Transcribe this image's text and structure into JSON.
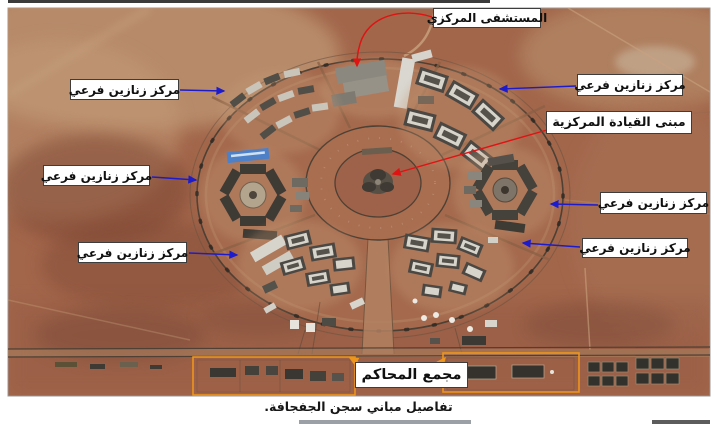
{
  "figure": {
    "caption": "تفاصيل مباني سجن الجفجافة."
  },
  "annotations": {
    "labels": [
      {
        "id": "central-hospital",
        "text": "المستشفى المركزي",
        "arrow_color": "#e01212"
      },
      {
        "id": "sub-cells-nw",
        "text": "مركز زنازين فرعي",
        "arrow_color": "#1c1ccd"
      },
      {
        "id": "sub-cells-ne",
        "text": "مركز زنازين فرعي",
        "arrow_color": "#1c1ccd"
      },
      {
        "id": "central-command",
        "text": "مبنى القيادة المركزية",
        "arrow_color": "#e01212"
      },
      {
        "id": "sub-cells-w",
        "text": "مركز زنازين فرعي",
        "arrow_color": "#1c1ccd"
      },
      {
        "id": "sub-cells-e",
        "text": "مركز زنازين فرعي",
        "arrow_color": "#1c1ccd"
      },
      {
        "id": "sub-cells-sw",
        "text": "مركز زنازين فرعي",
        "arrow_color": "#1c1ccd"
      },
      {
        "id": "sub-cells-se",
        "text": "مركز زنازين فرعي",
        "arrow_color": "#1c1ccd"
      },
      {
        "id": "courts-complex",
        "text": "مجمع المحاكم",
        "arrow_color": "#ee951c"
      }
    ]
  },
  "colors": {
    "arrow_blue": "#1c1ccd",
    "arrow_red": "#e01212",
    "arrow_orange": "#ee951c",
    "label_background": "#ffffff",
    "label_border": "#3d3d3d"
  }
}
